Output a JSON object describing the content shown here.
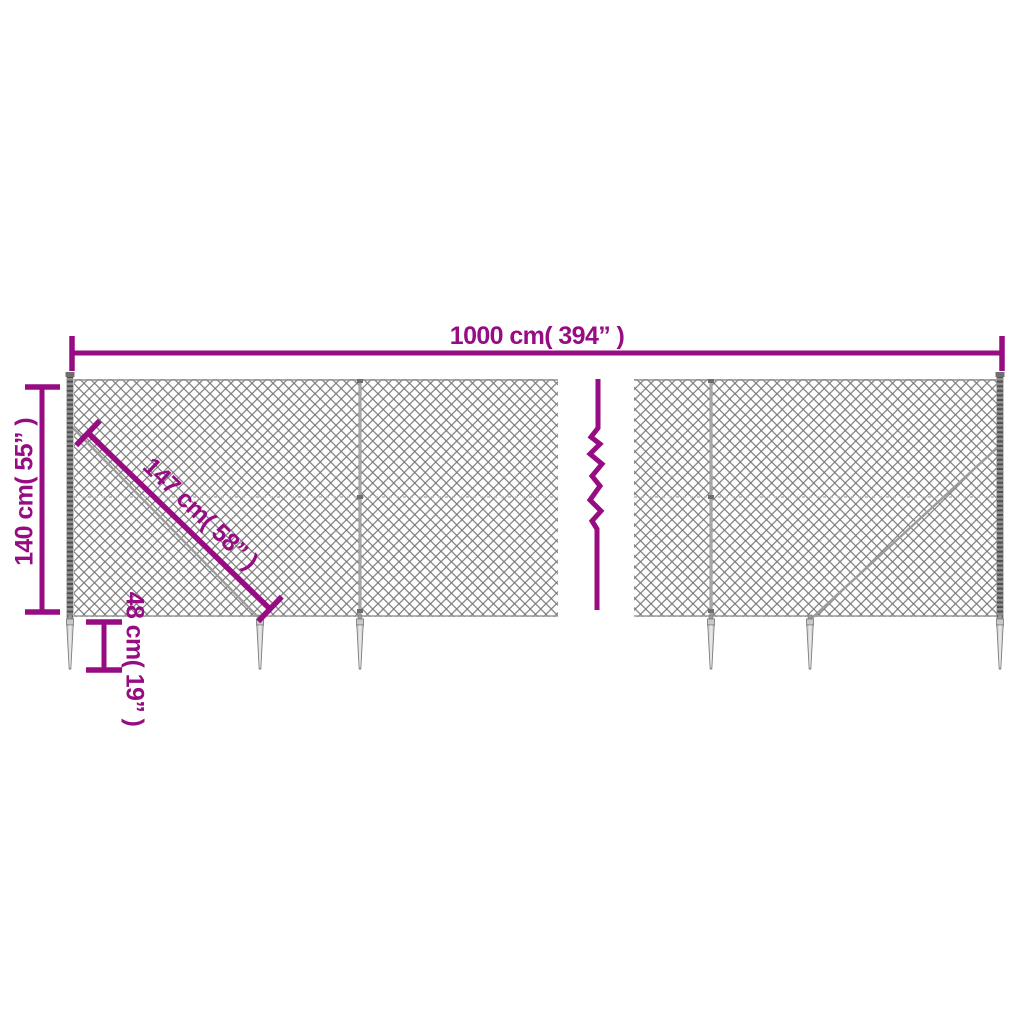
{
  "diagram": {
    "labels": {
      "total_width": "1000 cm( 394” )",
      "fence_height": "140 cm( 55” )",
      "brace_length": "147 cm( 58” )",
      "spike_length": "48 cm( 19” )"
    },
    "colors": {
      "dimension_accent": "#970c82",
      "mesh_gray": "#878787",
      "post_gray": "#6f6f6f",
      "spike_fill": "#d9d9d9",
      "background": "#ffffff"
    },
    "elements": [
      "chain-link-mesh",
      "fence-post",
      "ground-spike",
      "diagonal-brace-wire",
      "length-break-zigzag",
      "dimension-line"
    ]
  }
}
